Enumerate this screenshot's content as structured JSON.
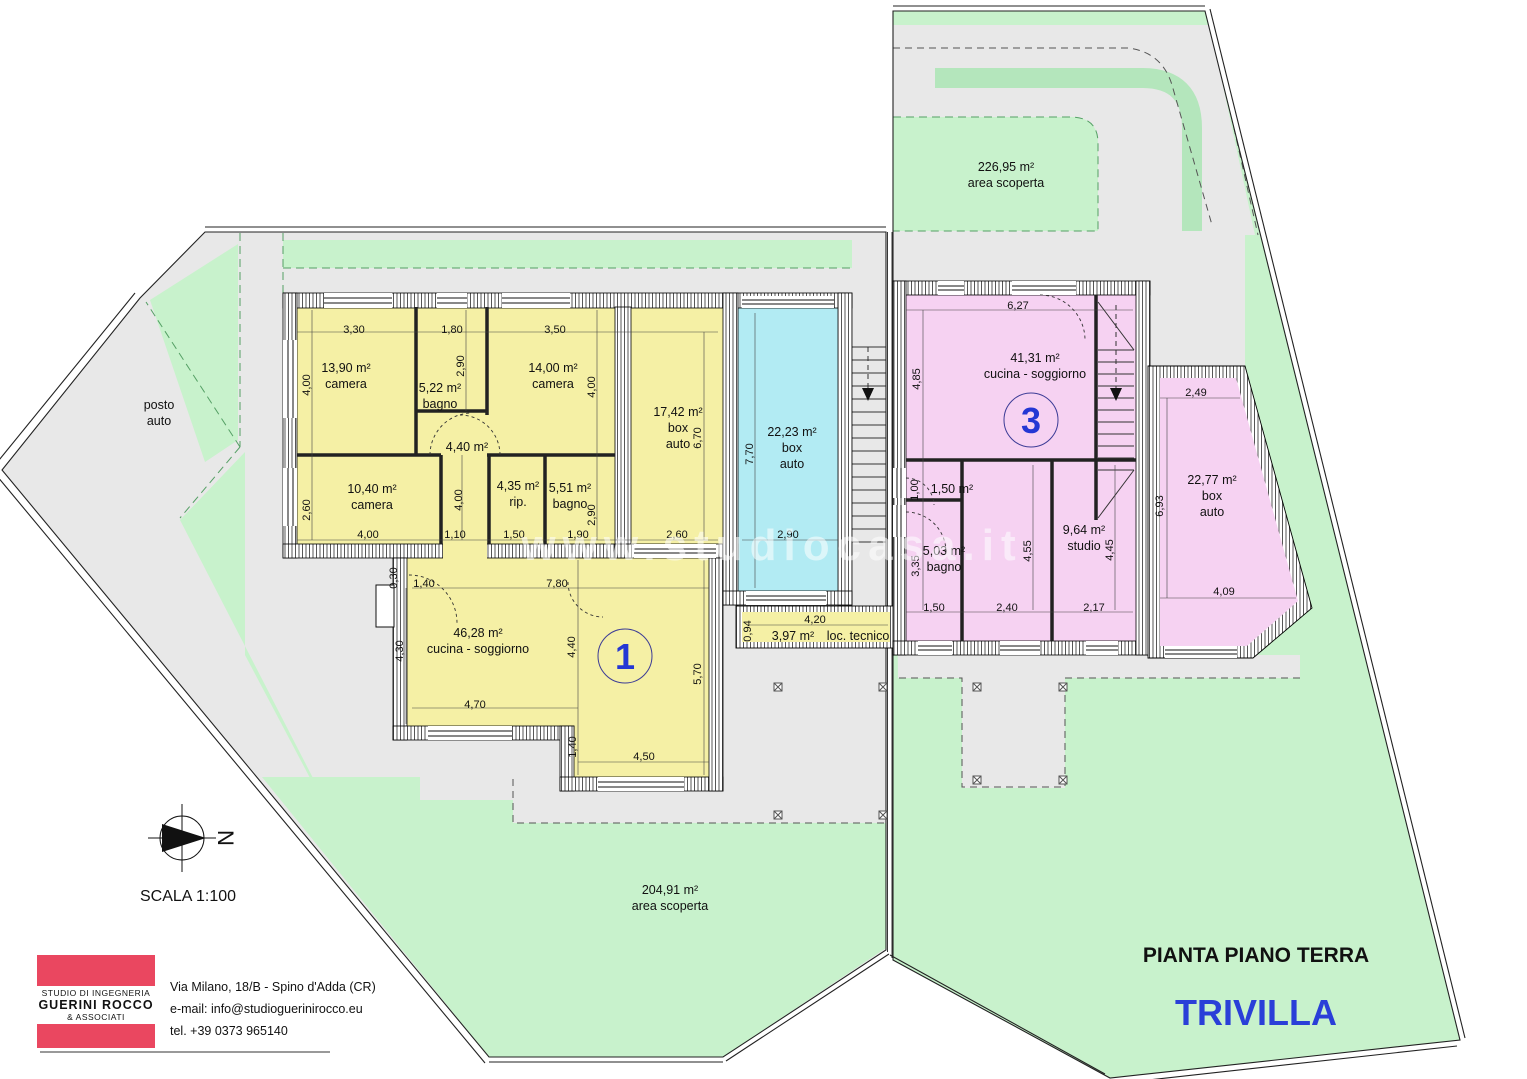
{
  "colors": {
    "room_yellow": "#f5f0a5",
    "room_pink": "#f6d2f2",
    "room_cyan": "#b2ebf3",
    "lawn_green": "#c8f2cc",
    "hedge_green": "#b4e6bc",
    "paving_gray": "#e8e8e8",
    "logo_red": "#ea4760",
    "title_blue": "#2a3fd8",
    "badge_blue": "#2437d4"
  },
  "plan": {
    "drawing_title": "PIANTA PIANO TERRA",
    "project_title": "TRIVILLA",
    "scale_label": "SCALA 1:100",
    "north_letter": "N",
    "watermark": "www.studiocasa.it"
  },
  "studio": {
    "name_line1": "STUDIO DI INGEGNERIA",
    "name_line2": "GUERINI ROCCO",
    "name_line3": "& ASSOCIATI",
    "address": "Via Milano, 18/B - Spino d'Adda (CR)",
    "email": "e-mail: info@studioguerinirocco.eu",
    "phone": "tel. +39 0373 965140"
  },
  "units": [
    {
      "number": "1",
      "x": 625,
      "y": 656
    },
    {
      "number": "3",
      "x": 1031,
      "y": 420
    }
  ],
  "labels": [
    {
      "lines": [
        "13,90 m²",
        "camera"
      ],
      "x": 346,
      "y": 368
    },
    {
      "lines": [
        "5,22 m²",
        "bagno"
      ],
      "x": 440,
      "y": 388
    },
    {
      "lines": [
        "14,00 m²",
        "camera"
      ],
      "x": 553,
      "y": 368
    },
    {
      "lines": [
        "17,42 m²",
        "box",
        "auto"
      ],
      "x": 678,
      "y": 412
    },
    {
      "lines": [
        "4,40 m²"
      ],
      "x": 467,
      "y": 447
    },
    {
      "lines": [
        "10,40 m²",
        "camera"
      ],
      "x": 372,
      "y": 489
    },
    {
      "lines": [
        "4,35 m²",
        "rip."
      ],
      "x": 518,
      "y": 486
    },
    {
      "lines": [
        "5,51 m²",
        "bagno"
      ],
      "x": 570,
      "y": 488
    },
    {
      "lines": [
        "22,23 m²",
        "box",
        "auto"
      ],
      "x": 792,
      "y": 432
    },
    {
      "lines": [
        "46,28 m²",
        "cucina - soggiorno"
      ],
      "x": 478,
      "y": 633
    },
    {
      "lines": [
        "3,97 m²"
      ],
      "x": 793,
      "y": 636
    },
    {
      "lines": [
        "loc. tecnico"
      ],
      "x": 858,
      "y": 636
    },
    {
      "lines": [
        "41,31 m²",
        "cucina - soggiorno"
      ],
      "x": 1035,
      "y": 358
    },
    {
      "lines": [
        "1,50 m²"
      ],
      "x": 952,
      "y": 489
    },
    {
      "lines": [
        "5,03 m²",
        "bagno"
      ],
      "x": 944,
      "y": 551
    },
    {
      "lines": [
        "9,64 m²",
        "studio"
      ],
      "x": 1084,
      "y": 530
    },
    {
      "lines": [
        "22,77 m²",
        "box",
        "auto"
      ],
      "x": 1212,
      "y": 480
    },
    {
      "lines": [
        "226,95 m²",
        "area scoperta"
      ],
      "x": 1006,
      "y": 167
    },
    {
      "lines": [
        "204,91 m²",
        "area scoperta"
      ],
      "x": 670,
      "y": 890
    },
    {
      "lines": [
        "posto",
        "auto"
      ],
      "x": 159,
      "y": 405
    }
  ],
  "dimensions": [
    {
      "t": "3,30",
      "x": 354,
      "y": 329
    },
    {
      "t": "1,80",
      "x": 452,
      "y": 329
    },
    {
      "t": "3,50",
      "x": 555,
      "y": 329
    },
    {
      "t": "4,00",
      "x": 310,
      "y": 381,
      "r": 1
    },
    {
      "t": "2,90",
      "x": 464,
      "y": 362,
      "r": 1
    },
    {
      "t": "4,00",
      "x": 595,
      "y": 383,
      "r": 1
    },
    {
      "t": "6,70",
      "x": 701,
      "y": 434,
      "r": 1
    },
    {
      "t": "7,70",
      "x": 753,
      "y": 450,
      "r": 1
    },
    {
      "t": "2,60",
      "x": 310,
      "y": 506,
      "r": 1
    },
    {
      "t": "4,00",
      "x": 462,
      "y": 496,
      "r": 1
    },
    {
      "t": "2,90",
      "x": 595,
      "y": 511,
      "r": 1
    },
    {
      "t": "4,00",
      "x": 368,
      "y": 534
    },
    {
      "t": "1,10",
      "x": 455,
      "y": 534
    },
    {
      "t": "1,50",
      "x": 514,
      "y": 534
    },
    {
      "t": "1,90",
      "x": 578,
      "y": 534
    },
    {
      "t": "2,60",
      "x": 677,
      "y": 534
    },
    {
      "t": "2,90",
      "x": 788,
      "y": 534
    },
    {
      "t": "0,30",
      "x": 397,
      "y": 574,
      "r": 1
    },
    {
      "t": "1,40",
      "x": 424,
      "y": 583
    },
    {
      "t": "7,80",
      "x": 557,
      "y": 583
    },
    {
      "t": "4,30",
      "x": 403,
      "y": 647,
      "r": 1
    },
    {
      "t": "4,40",
      "x": 575,
      "y": 643,
      "r": 1
    },
    {
      "t": "5,70",
      "x": 701,
      "y": 670,
      "r": 1
    },
    {
      "t": "4,70",
      "x": 475,
      "y": 704
    },
    {
      "t": "1,40",
      "x": 576,
      "y": 743,
      "r": 1
    },
    {
      "t": "4,50",
      "x": 644,
      "y": 756
    },
    {
      "t": "0,94",
      "x": 751,
      "y": 627,
      "r": 1
    },
    {
      "t": "4,20",
      "x": 815,
      "y": 619
    },
    {
      "t": "6,27",
      "x": 1018,
      "y": 305
    },
    {
      "t": "4,85",
      "x": 920,
      "y": 375,
      "r": 1
    },
    {
      "t": "1,00",
      "x": 918,
      "y": 486,
      "r": 1
    },
    {
      "t": "3,35",
      "x": 919,
      "y": 562,
      "r": 1
    },
    {
      "t": "4,55",
      "x": 1031,
      "y": 547,
      "r": 1
    },
    {
      "t": "4,45",
      "x": 1113,
      "y": 546,
      "r": 1
    },
    {
      "t": "1,50",
      "x": 934,
      "y": 607
    },
    {
      "t": "2,40",
      "x": 1007,
      "y": 607
    },
    {
      "t": "2,17",
      "x": 1094,
      "y": 607
    },
    {
      "t": "2,49",
      "x": 1196,
      "y": 392
    },
    {
      "t": "6,93",
      "x": 1163,
      "y": 502,
      "r": 1
    },
    {
      "t": "4,09",
      "x": 1224,
      "y": 591
    }
  ],
  "markers": [
    {
      "x": 778,
      "y": 687
    },
    {
      "x": 883,
      "y": 687
    },
    {
      "x": 778,
      "y": 815
    },
    {
      "x": 883,
      "y": 815
    },
    {
      "x": 977,
      "y": 687
    },
    {
      "x": 1063,
      "y": 687
    },
    {
      "x": 977,
      "y": 780
    },
    {
      "x": 1063,
      "y": 780
    }
  ]
}
